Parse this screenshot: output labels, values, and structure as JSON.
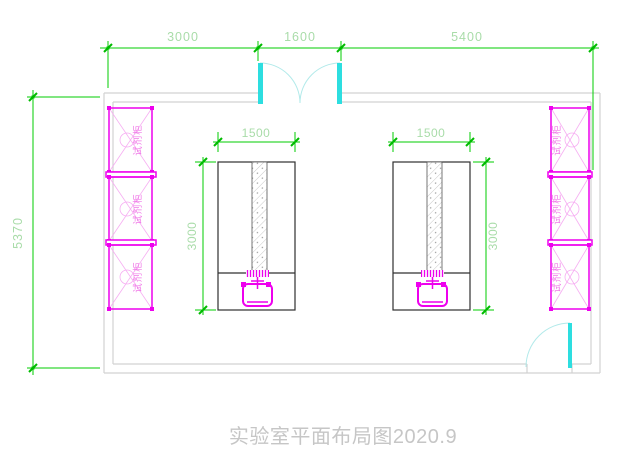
{
  "drawing": {
    "title": "实验室平面布局图2020.9",
    "dims": {
      "top_left": "3000",
      "top_mid": "1600",
      "top_right": "5400",
      "left_height": "5370",
      "bench_width": "1500",
      "bench_depth": "3000"
    },
    "cabinet_label": "试剂柜",
    "cabinet_count_left": 3,
    "cabinet_count_right": 3,
    "colors": {
      "dimension_line": "#00cc00",
      "dimension_text": "#a9dca9",
      "wall": "#d2d2d2",
      "door": "#2ddee0",
      "door_arc": "#b2eaea",
      "cabinet": "#ee00ee",
      "cabinet_light": "#f6aef2",
      "bench_outline": "#303030",
      "title_text": "#c6c6c6"
    }
  }
}
